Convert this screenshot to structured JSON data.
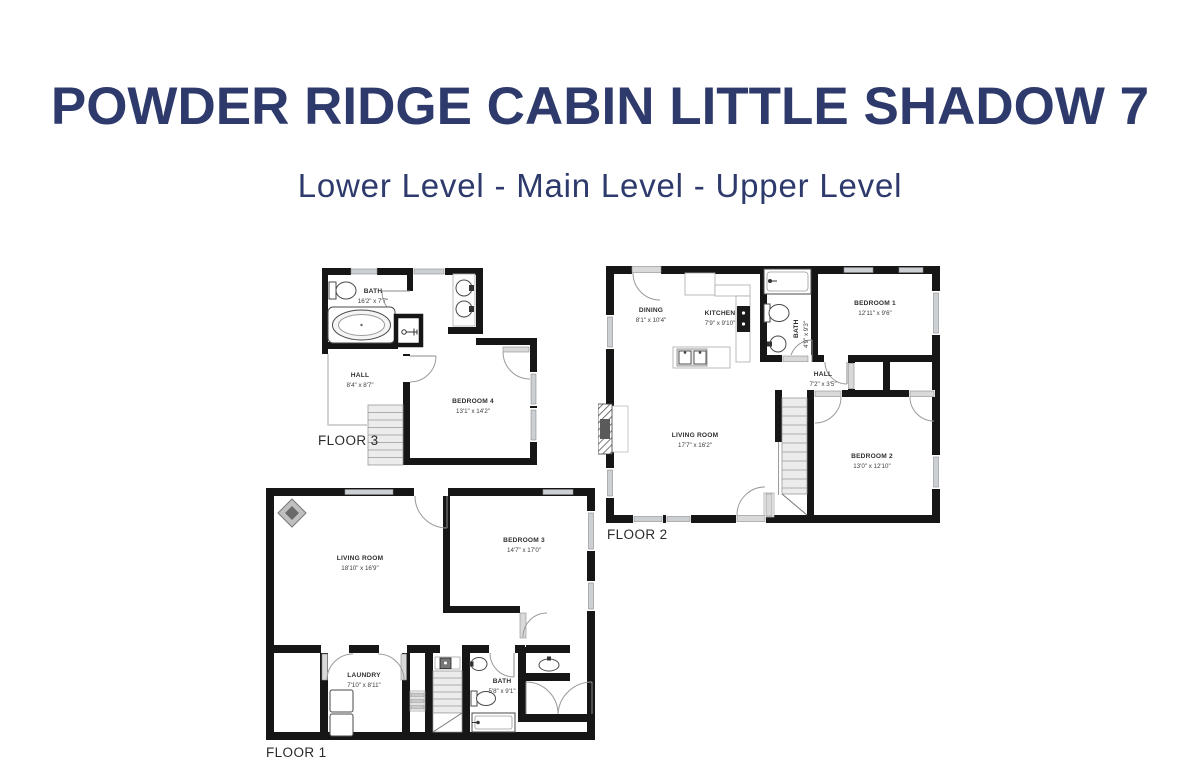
{
  "header": {
    "title": "POWDER RIDGE CABIN LITTLE SHADOW 7",
    "subtitle": "Lower Level - Main Level - Upper Level"
  },
  "colors": {
    "accent": "#2d3a6b",
    "wall": "#161616",
    "room_label": "#2f2f2f"
  },
  "floor3": {
    "label": "FLOOR 3",
    "bath": {
      "name": "BATH",
      "dims": "16'2\" x 7'7\""
    },
    "hall": {
      "name": "HALL",
      "dims": "8'4\" x 8'7\""
    },
    "bedroom4": {
      "name": "BEDROOM 4",
      "dims": "13'1\" x 14'2\""
    }
  },
  "floor2": {
    "label": "FLOOR 2",
    "dining": {
      "name": "DINING",
      "dims": "8'1\" x 10'4\""
    },
    "kitchen": {
      "name": "KITCHEN",
      "dims": "7'9\" x 9'10\""
    },
    "bath": {
      "name": "BATH",
      "dims": "4'9\" x 9'3\""
    },
    "bedroom1": {
      "name": "BEDROOM 1",
      "dims": "12'11\" x 9'6\""
    },
    "hall": {
      "name": "HALL",
      "dims": "7'2\" x 3'5\""
    },
    "living": {
      "name": "LIVING ROOM",
      "dims": "17'7\" x 16'2\""
    },
    "bedroom2": {
      "name": "BEDROOM 2",
      "dims": "13'0\" x 12'10\""
    }
  },
  "floor1": {
    "label": "FLOOR 1",
    "living": {
      "name": "LIVING ROOM",
      "dims": "18'10\" x 16'9\""
    },
    "bedroom3": {
      "name": "BEDROOM 3",
      "dims": "14'7\" x 17'0\""
    },
    "laundry": {
      "name": "LAUNDRY",
      "dims": "7'10\" x 8'11\""
    },
    "bath": {
      "name": "BATH",
      "dims": "5'8\" x 9'1\""
    }
  }
}
